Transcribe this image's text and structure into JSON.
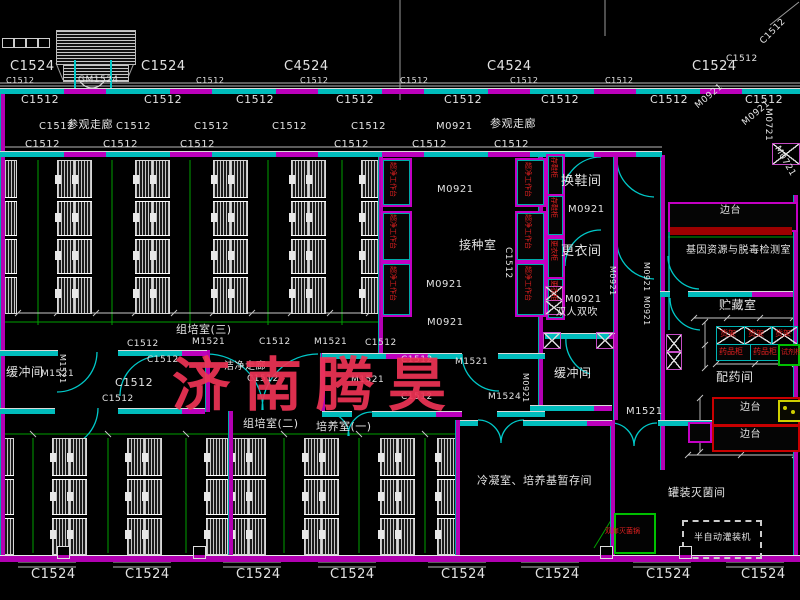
{
  "drawing": {
    "watermark": {
      "text": "济南腾昊",
      "color": "#ee3355"
    },
    "colors": {
      "wall": "#b400b4",
      "window_band": "#00bcbc",
      "grid": "#00a000",
      "label_text": "#e2e2e2",
      "equipment_text": "#e02020",
      "dim_line": "#c8c8c8"
    },
    "labels": [
      {
        "t": "C1524",
        "x": 10,
        "y": 60,
        "s": 13
      },
      {
        "t": "C1524",
        "x": 141,
        "y": 60,
        "s": 13
      },
      {
        "t": "C4524",
        "x": 284,
        "y": 60,
        "s": 13
      },
      {
        "t": "C4524",
        "x": 487,
        "y": 60,
        "s": 13
      },
      {
        "t": "C1524",
        "x": 692,
        "y": 60,
        "s": 13
      },
      {
        "t": "C1512",
        "x": 726,
        "y": 55,
        "s": 9
      },
      {
        "t": "C1512",
        "x": 759,
        "y": 40,
        "s": 9,
        "r": -45
      },
      {
        "t": "GM1524",
        "x": 78,
        "y": 76,
        "s": 9
      },
      {
        "t": "C1512",
        "x": 6,
        "y": 77,
        "s": 8
      },
      {
        "t": "C1512",
        "x": 196,
        "y": 77,
        "s": 8
      },
      {
        "t": "C1512",
        "x": 300,
        "y": 77,
        "s": 8
      },
      {
        "t": "C1512",
        "x": 400,
        "y": 77,
        "s": 8
      },
      {
        "t": "C1512",
        "x": 510,
        "y": 77,
        "s": 8
      },
      {
        "t": "C1512",
        "x": 605,
        "y": 77,
        "s": 8
      },
      {
        "t": "C1512",
        "x": 21,
        "y": 94,
        "s": 11
      },
      {
        "t": "C1512",
        "x": 144,
        "y": 94,
        "s": 11
      },
      {
        "t": "C1512",
        "x": 236,
        "y": 94,
        "s": 11
      },
      {
        "t": "C1512",
        "x": 336,
        "y": 94,
        "s": 11
      },
      {
        "t": "C1512",
        "x": 444,
        "y": 94,
        "s": 11
      },
      {
        "t": "C1512",
        "x": 541,
        "y": 94,
        "s": 11
      },
      {
        "t": "C1512",
        "x": 650,
        "y": 94,
        "s": 11
      },
      {
        "t": "C1512",
        "x": 745,
        "y": 94,
        "s": 11
      },
      {
        "t": "C1512",
        "x": 39,
        "y": 122,
        "s": 10
      },
      {
        "t": "参观走廊",
        "x": 67,
        "y": 119,
        "s": 11
      },
      {
        "t": "C1512",
        "x": 116,
        "y": 122,
        "s": 10
      },
      {
        "t": "C1512",
        "x": 194,
        "y": 122,
        "s": 10
      },
      {
        "t": "C1512",
        "x": 272,
        "y": 122,
        "s": 10
      },
      {
        "t": "C1512",
        "x": 351,
        "y": 122,
        "s": 10
      },
      {
        "t": "M0921",
        "x": 436,
        "y": 122,
        "s": 10
      },
      {
        "t": "参观走廊",
        "x": 490,
        "y": 118,
        "s": 11
      },
      {
        "t": "C1512",
        "x": 25,
        "y": 140,
        "s": 10
      },
      {
        "t": "C1512",
        "x": 103,
        "y": 140,
        "s": 10
      },
      {
        "t": "C1512",
        "x": 180,
        "y": 140,
        "s": 10
      },
      {
        "t": "C1512",
        "x": 334,
        "y": 140,
        "s": 10
      },
      {
        "t": "C1512",
        "x": 412,
        "y": 140,
        "s": 10
      },
      {
        "t": "C1512",
        "x": 494,
        "y": 140,
        "s": 10
      },
      {
        "t": "M0921",
        "x": 694,
        "y": 104,
        "s": 9,
        "r": -40
      },
      {
        "t": "M0921",
        "x": 741,
        "y": 121,
        "s": 9,
        "r": -40
      },
      {
        "t": "M0721",
        "x": 772,
        "y": 108,
        "s": 9,
        "r": 90
      },
      {
        "t": "M0721",
        "x": 780,
        "y": 145,
        "s": 9,
        "r": 60
      },
      {
        "t": "M0921",
        "x": 437,
        "y": 185,
        "s": 10
      },
      {
        "t": "接种室",
        "x": 459,
        "y": 239,
        "s": 12
      },
      {
        "t": "M0921",
        "x": 426,
        "y": 280,
        "s": 10
      },
      {
        "t": "M0921",
        "x": 427,
        "y": 318,
        "s": 10
      },
      {
        "t": "C1512",
        "x": 512,
        "y": 247,
        "s": 9,
        "r": 90
      },
      {
        "t": "换鞋间",
        "x": 561,
        "y": 175,
        "s": 13
      },
      {
        "t": "M0921",
        "x": 568,
        "y": 205,
        "s": 10
      },
      {
        "t": "更衣间",
        "x": 561,
        "y": 245,
        "s": 13
      },
      {
        "t": "M0921",
        "x": 565,
        "y": 295,
        "s": 10
      },
      {
        "t": "双人双吹",
        "x": 556,
        "y": 308,
        "s": 10
      },
      {
        "t": "组培室(三)",
        "x": 176,
        "y": 324,
        "s": 11
      },
      {
        "t": "M1521",
        "x": 192,
        "y": 338,
        "s": 9
      },
      {
        "t": "C1512",
        "x": 127,
        "y": 340,
        "s": 9
      },
      {
        "t": "C1512",
        "x": 147,
        "y": 356,
        "s": 9
      },
      {
        "t": "C1512",
        "x": 115,
        "y": 377,
        "s": 11
      },
      {
        "t": "C1512",
        "x": 102,
        "y": 395,
        "s": 9
      },
      {
        "t": "缓冲间",
        "x": 6,
        "y": 366,
        "s": 12
      },
      {
        "t": "M1521",
        "x": 41,
        "y": 370,
        "s": 9
      },
      {
        "t": "M1521",
        "x": 66,
        "y": 354,
        "s": 8,
        "r": 90
      },
      {
        "t": "M1521",
        "x": 314,
        "y": 338,
        "s": 9
      },
      {
        "t": "C1512",
        "x": 259,
        "y": 338,
        "s": 9
      },
      {
        "t": "C1512",
        "x": 365,
        "y": 339,
        "s": 9
      },
      {
        "t": "洁净走廊",
        "x": 224,
        "y": 362,
        "s": 10
      },
      {
        "t": "C1512",
        "x": 247,
        "y": 375,
        "s": 9
      },
      {
        "t": "M1521",
        "x": 351,
        "y": 376,
        "s": 9
      },
      {
        "t": "C1512",
        "x": 401,
        "y": 356,
        "s": 9
      },
      {
        "t": "C1512",
        "x": 401,
        "y": 393,
        "s": 9
      },
      {
        "t": "M1524",
        "x": 488,
        "y": 393,
        "s": 9
      },
      {
        "t": "M1521",
        "x": 455,
        "y": 358,
        "s": 9
      },
      {
        "t": "缓冲间",
        "x": 554,
        "y": 367,
        "s": 12
      },
      {
        "t": "M0921",
        "x": 529,
        "y": 373,
        "s": 8,
        "r": 90
      },
      {
        "t": "M0921",
        "x": 616,
        "y": 266,
        "s": 8,
        "r": 90
      },
      {
        "t": "M1521",
        "x": 626,
        "y": 407,
        "s": 10
      },
      {
        "t": "M0921",
        "x": 650,
        "y": 262,
        "s": 8,
        "r": 90
      },
      {
        "t": "M0921",
        "x": 650,
        "y": 296,
        "s": 8,
        "r": 90
      },
      {
        "t": "边台",
        "x": 720,
        "y": 206,
        "s": 10
      },
      {
        "t": "基因资源与脱毒检测室",
        "x": 686,
        "y": 246,
        "s": 10
      },
      {
        "t": "贮藏室",
        "x": 719,
        "y": 299,
        "s": 12
      },
      {
        "t": "货架",
        "x": 720,
        "y": 330,
        "s": 8,
        "c": "red",
        "n": "equipment-label"
      },
      {
        "t": "货架",
        "x": 748,
        "y": 330,
        "s": 8,
        "c": "red",
        "n": "equipment-label"
      },
      {
        "t": "货架",
        "x": 775,
        "y": 330,
        "s": 8,
        "c": "red",
        "n": "equipment-label"
      },
      {
        "t": "药品柜",
        "x": 719,
        "y": 348,
        "s": 8,
        "c": "red",
        "n": "equipment-label"
      },
      {
        "t": "药品柜",
        "x": 753,
        "y": 348,
        "s": 8,
        "c": "red",
        "n": "equipment-label"
      },
      {
        "t": "试剂柜",
        "x": 781,
        "y": 349,
        "s": 7,
        "c": "red",
        "n": "equipment-label"
      },
      {
        "t": "配药间",
        "x": 716,
        "y": 371,
        "s": 12
      },
      {
        "t": "边台",
        "x": 740,
        "y": 403,
        "s": 10
      },
      {
        "t": "边台",
        "x": 740,
        "y": 430,
        "s": 10
      },
      {
        "t": "组培室(二)",
        "x": 243,
        "y": 418,
        "s": 11
      },
      {
        "t": "培养室(一)",
        "x": 316,
        "y": 421,
        "s": 11
      },
      {
        "t": "冷凝室、培养基暂存间",
        "x": 477,
        "y": 475,
        "s": 11
      },
      {
        "t": "罐装灭菌间",
        "x": 668,
        "y": 487,
        "s": 11
      },
      {
        "t": "双扉灭菌锅",
        "x": 605,
        "y": 528,
        "s": 7,
        "c": "red",
        "n": "equipment-label"
      },
      {
        "t": "半自动灌装机",
        "x": 694,
        "y": 534,
        "s": 9
      },
      {
        "t": "C1524",
        "x": 31,
        "y": 568,
        "s": 13
      },
      {
        "t": "C1524",
        "x": 125,
        "y": 568,
        "s": 13
      },
      {
        "t": "C1524",
        "x": 236,
        "y": 568,
        "s": 13
      },
      {
        "t": "C1524",
        "x": 330,
        "y": 568,
        "s": 13
      },
      {
        "t": "C1524",
        "x": 441,
        "y": 568,
        "s": 13
      },
      {
        "t": "C1524",
        "x": 535,
        "y": 568,
        "s": 13
      },
      {
        "t": "C1524",
        "x": 646,
        "y": 568,
        "s": 13
      },
      {
        "t": "C1524",
        "x": 741,
        "y": 568,
        "s": 13
      },
      {
        "t": "超净工作台",
        "x": 396,
        "y": 162,
        "s": 7,
        "c": "red",
        "r": 90,
        "n": "equipment-label"
      },
      {
        "t": "超净工作台",
        "x": 396,
        "y": 214,
        "s": 7,
        "c": "red",
        "r": 90,
        "n": "equipment-label"
      },
      {
        "t": "超净工作台",
        "x": 396,
        "y": 266,
        "s": 7,
        "c": "red",
        "r": 90,
        "n": "equipment-label"
      },
      {
        "t": "超净工作台",
        "x": 531,
        "y": 162,
        "s": 7,
        "c": "red",
        "r": 90,
        "n": "equipment-label"
      },
      {
        "t": "超净工作台",
        "x": 531,
        "y": 214,
        "s": 7,
        "c": "red",
        "r": 90,
        "n": "equipment-label"
      },
      {
        "t": "超净工作台",
        "x": 531,
        "y": 266,
        "s": 7,
        "c": "red",
        "r": 90,
        "n": "equipment-label"
      },
      {
        "t": "存鞋柜",
        "x": 557,
        "y": 157,
        "s": 7,
        "c": "red",
        "r": 90,
        "n": "equipment-label"
      },
      {
        "t": "存鞋柜",
        "x": 557,
        "y": 197,
        "s": 7,
        "c": "red",
        "r": 90,
        "n": "equipment-label"
      },
      {
        "t": "更衣柜",
        "x": 557,
        "y": 240,
        "s": 7,
        "c": "red",
        "r": 90,
        "n": "equipment-label"
      },
      {
        "t": "更衣柜",
        "x": 557,
        "y": 280,
        "s": 7,
        "c": "red",
        "r": 90,
        "n": "equipment-label"
      }
    ]
  }
}
